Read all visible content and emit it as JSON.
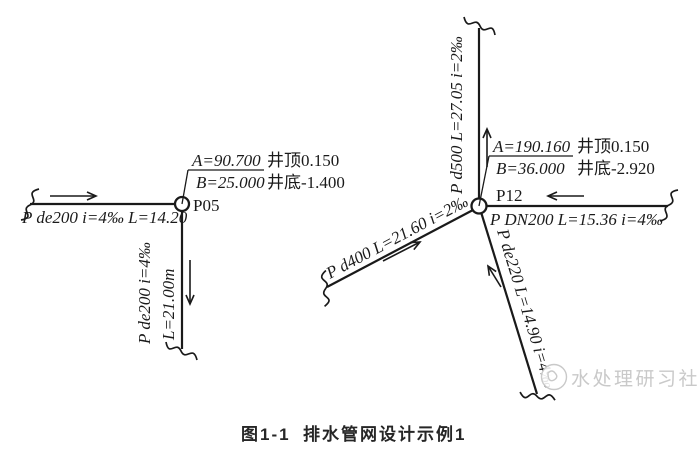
{
  "palette": {
    "line": "#1a1a1a",
    "watermark": "#c9c9c9",
    "background": "#ffffff"
  },
  "caption": {
    "figure_no": "图1-1",
    "title": "排水管网设计示例1"
  },
  "watermark": {
    "brand": "水处理研习社"
  },
  "manholes": {
    "p05": {
      "id": "P05",
      "annotation": {
        "a": "A=90.700",
        "a_note": "井顶0.150",
        "b": "B=25.000",
        "b_note": "井底-1.400"
      },
      "pipe_west": {
        "label": "P de200 i=4‰ L=14.20"
      },
      "pipe_south": {
        "label_spec": "P de200 i=4‰",
        "label_length": "L=21.00m"
      }
    },
    "p12": {
      "id": "P12",
      "annotation": {
        "a": "A=190.160",
        "a_note": "井顶0.150",
        "b": "B=36.000",
        "b_note": "井底-2.920"
      },
      "pipe_north": {
        "label": "P d500 L=27.05 i=2‰"
      },
      "pipe_east": {
        "label": "P DN200 L=15.36 i=4‰"
      },
      "pipe_southwest": {
        "label": "P d400 L=21.60 i=2‰"
      },
      "pipe_southeast": {
        "label": "P de220 L=14.90 i=4‰"
      }
    }
  }
}
